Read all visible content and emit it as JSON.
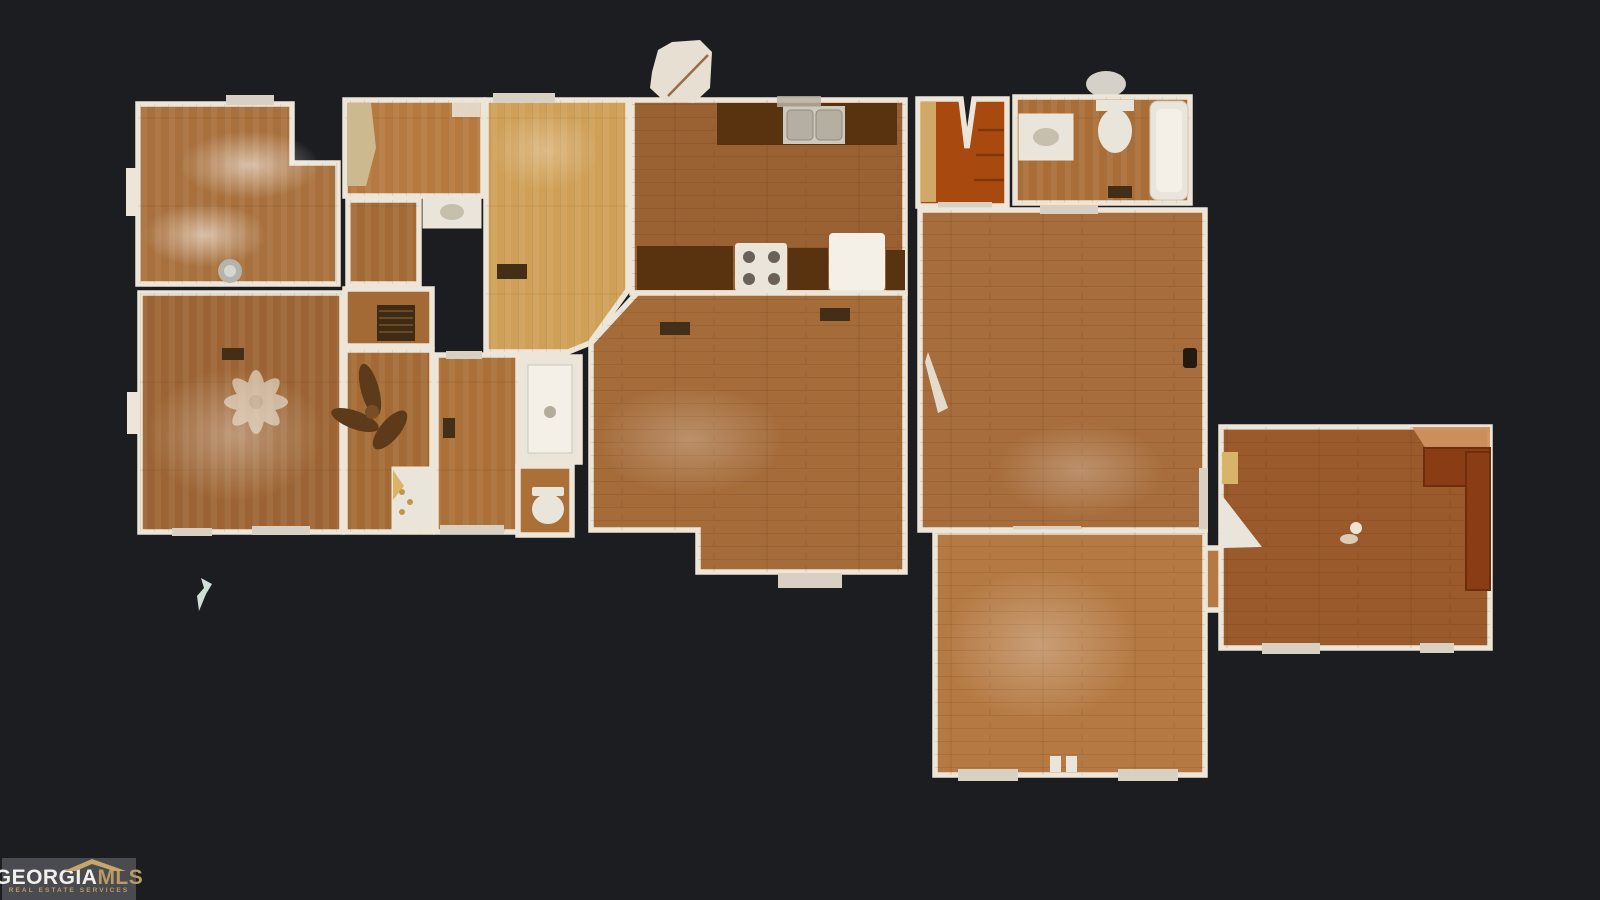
{
  "logo": {
    "brand_primary": "GEORGIA",
    "brand_secondary": "MLS",
    "tagline": "REAL ESTATE SERVICES"
  },
  "colors": {
    "background": "#1c1d20",
    "wall": "#ece5d8",
    "threshold": "#d8d1c3",
    "wood_bedroom1": "#a8703c",
    "wood_master": "#9c6434",
    "wood_closet": "#b6793f",
    "wood_hall": "#a46a35",
    "wood_mid": "#aa7038",
    "wood_parquet": "#cfa057",
    "wood_kitchen": "#9a6233",
    "wood_living": "#a56c3a",
    "wood_family": "#a76d3c",
    "wood_bonus": "#b57a43",
    "wood_den": "#9a5a2b",
    "wood_bath": "#a96e38",
    "counter": "#593310",
    "bar_counter": "#8a3d14",
    "bar_copper": "#cf9160",
    "stairs": "#a8490f",
    "stairs_trim": "#d9b978",
    "fixture": "#eae5da",
    "fixture_bright": "#f4f0e8",
    "fixture_shadow": "#c6bfae",
    "sink_metal": "#b5afa2",
    "appliance_knob": "#6b6257",
    "vent": "#432e18",
    "grate": "#3f2a14",
    "fan_dark": "#5d3a1a",
    "fan_hub_dark": "#7a4e24",
    "fan_light": "#efe9db",
    "gold_fixture": "#c2964a",
    "tan_box": "#d9b36a",
    "artifact_mint": "#cfe0d6",
    "artifact_cream": "#e7e0d2",
    "logo_bg": "#4a4a51",
    "logo_gold": "#b99c63",
    "logo_text": "#f2f0ec"
  },
  "floorplan": {
    "view": "top-down 3D scan floor plan",
    "rooms": [
      "bedroom-top-left",
      "closet-laundry",
      "inner-hall",
      "hall-grate",
      "dining-parquet",
      "kitchen",
      "living-room",
      "master-bedroom",
      "hallway-fan",
      "middle-bedroom",
      "shower-room",
      "toilet-room",
      "stairwell",
      "bathroom-top-right",
      "family-room",
      "bonus-room",
      "den-with-bar"
    ]
  }
}
